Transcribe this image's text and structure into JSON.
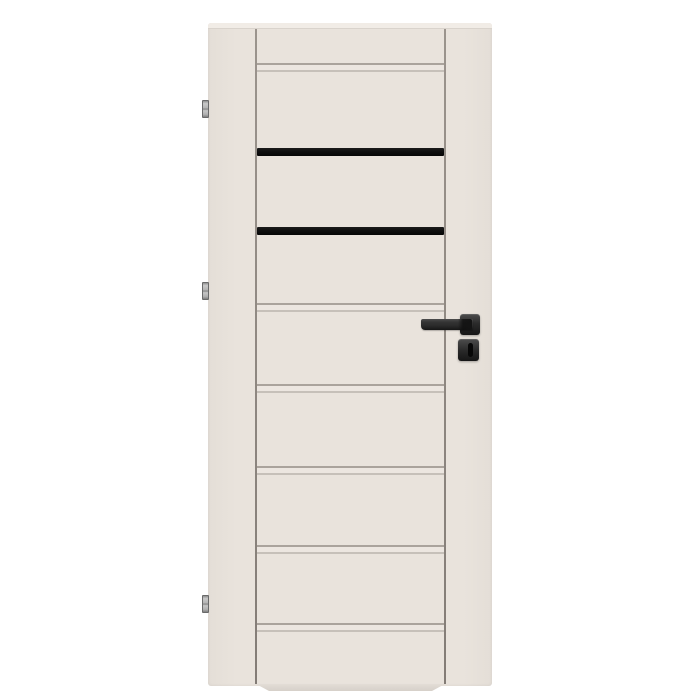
{
  "image": {
    "kind": "product-photo",
    "subject": "cream interior door with two black glass stripes, black square lever handle, keyhole escutcheon and three silver hinges on white background"
  },
  "palette": {
    "background": "#ffffff",
    "face": "#e9e3dc",
    "face_dark": "#e4ded7",
    "bevel": "#f1ece6",
    "bevel_line": "#d9d3cc",
    "gap_line": "#837c76",
    "gap_line_light": "#9b948d",
    "groove_dark": "#aaa39c",
    "groove_mid": "#ece6e0",
    "groove_dark2": "#c6c0b9",
    "stripe": "#101010",
    "lip_top": "#e3ddd6",
    "lip_bottom": "#d6d0c9",
    "hinge_dark": "#6a6a6a",
    "handle_hi": "#4d4d4d",
    "handle_mid": "#2b2b2b",
    "handle_dark": "#161616",
    "keyhole": "#070707"
  },
  "door": {
    "x": 208,
    "y": 23,
    "width": 284,
    "height": 663,
    "top_bevel": {
      "x": 208,
      "y": 23,
      "width": 284,
      "height": 6
    },
    "stile_gap_lines": {
      "xs": [
        255,
        444
      ],
      "y": 29,
      "width": 2,
      "height": 655
    },
    "groove_bands": {
      "x": 257,
      "width": 187,
      "height": 9,
      "tops": [
        63,
        303,
        384,
        466,
        545,
        623
      ]
    },
    "glass_stripes": {
      "x": 257,
      "width": 187,
      "items": [
        {
          "y": 148,
          "height": 8
        },
        {
          "y": 227,
          "height": 8
        }
      ]
    },
    "bottom_lip": {
      "x": 256,
      "y": 684,
      "width": 189,
      "height": 7
    }
  },
  "hinges": {
    "x": 202,
    "width": 7,
    "height": 18,
    "tops": [
      100,
      282,
      595
    ]
  },
  "handle": {
    "lever": {
      "x": 421,
      "y": 319,
      "width": 52,
      "height": 11
    },
    "neck": {
      "x": 458,
      "y": 319,
      "width": 14,
      "height": 11
    },
    "rosette": {
      "x": 460,
      "y": 314,
      "width": 20,
      "height": 21
    },
    "escutcheon": {
      "x": 458,
      "y": 339,
      "width": 21,
      "height": 22
    },
    "keyhole": {
      "x": 468,
      "y": 343,
      "width": 5,
      "height": 14
    }
  }
}
